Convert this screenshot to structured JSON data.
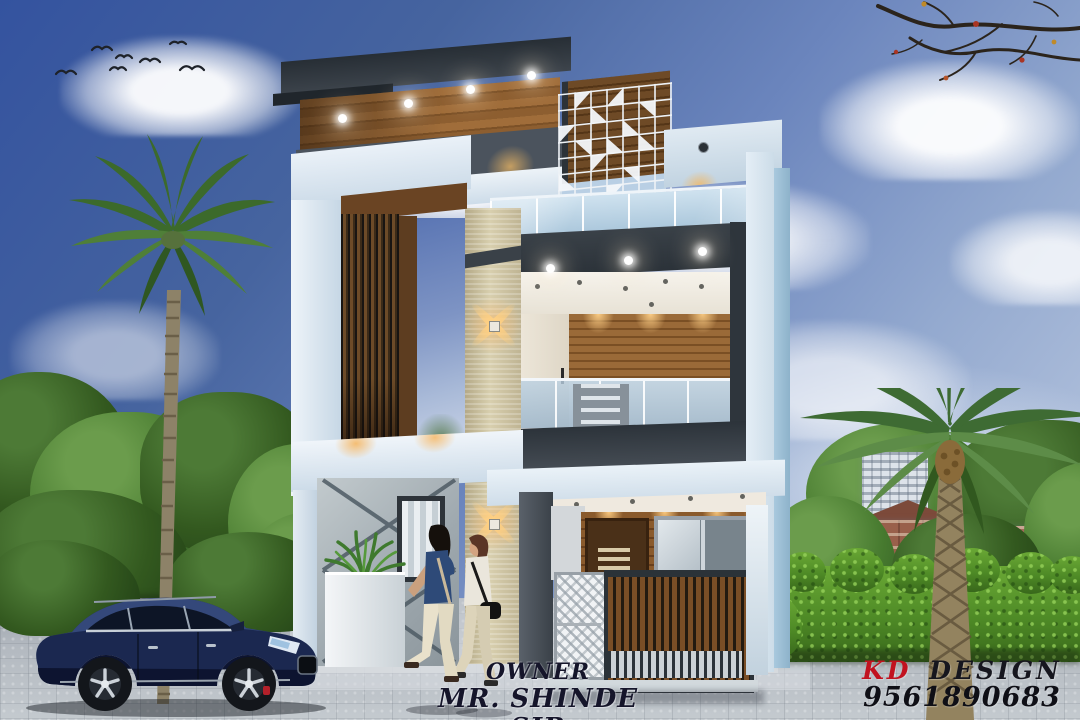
{
  "scene": {
    "description": "3D architectural elevation render of a modern two-storey house with palm trees, hedge, navy SUV and two pedestrians"
  },
  "captions": {
    "owner_label": "OWNER",
    "owner_name": "MR. SHINDE SIR"
  },
  "branding": {
    "logo_first": "KD",
    "logo_rest": "DESIGN",
    "phone": "9561890683",
    "logo_first_color": "#c1121f",
    "logo_rest_color": "#16161e"
  },
  "palette": {
    "sky_top": "#34539f",
    "sky_bottom": "#c3cfe4",
    "wall_white": "#dce9f3",
    "wall_side_blue": "#a9c9de",
    "charcoal": "#333a41",
    "wood_brown": "#8a5a2c",
    "stone_beige": "#d8cfae",
    "hedge_green": "#4e8a26",
    "tree_green": "#33591f",
    "road_gray": "#b3b9c0",
    "car_navy": "#18234a",
    "warm_light": "#f5c07a"
  }
}
